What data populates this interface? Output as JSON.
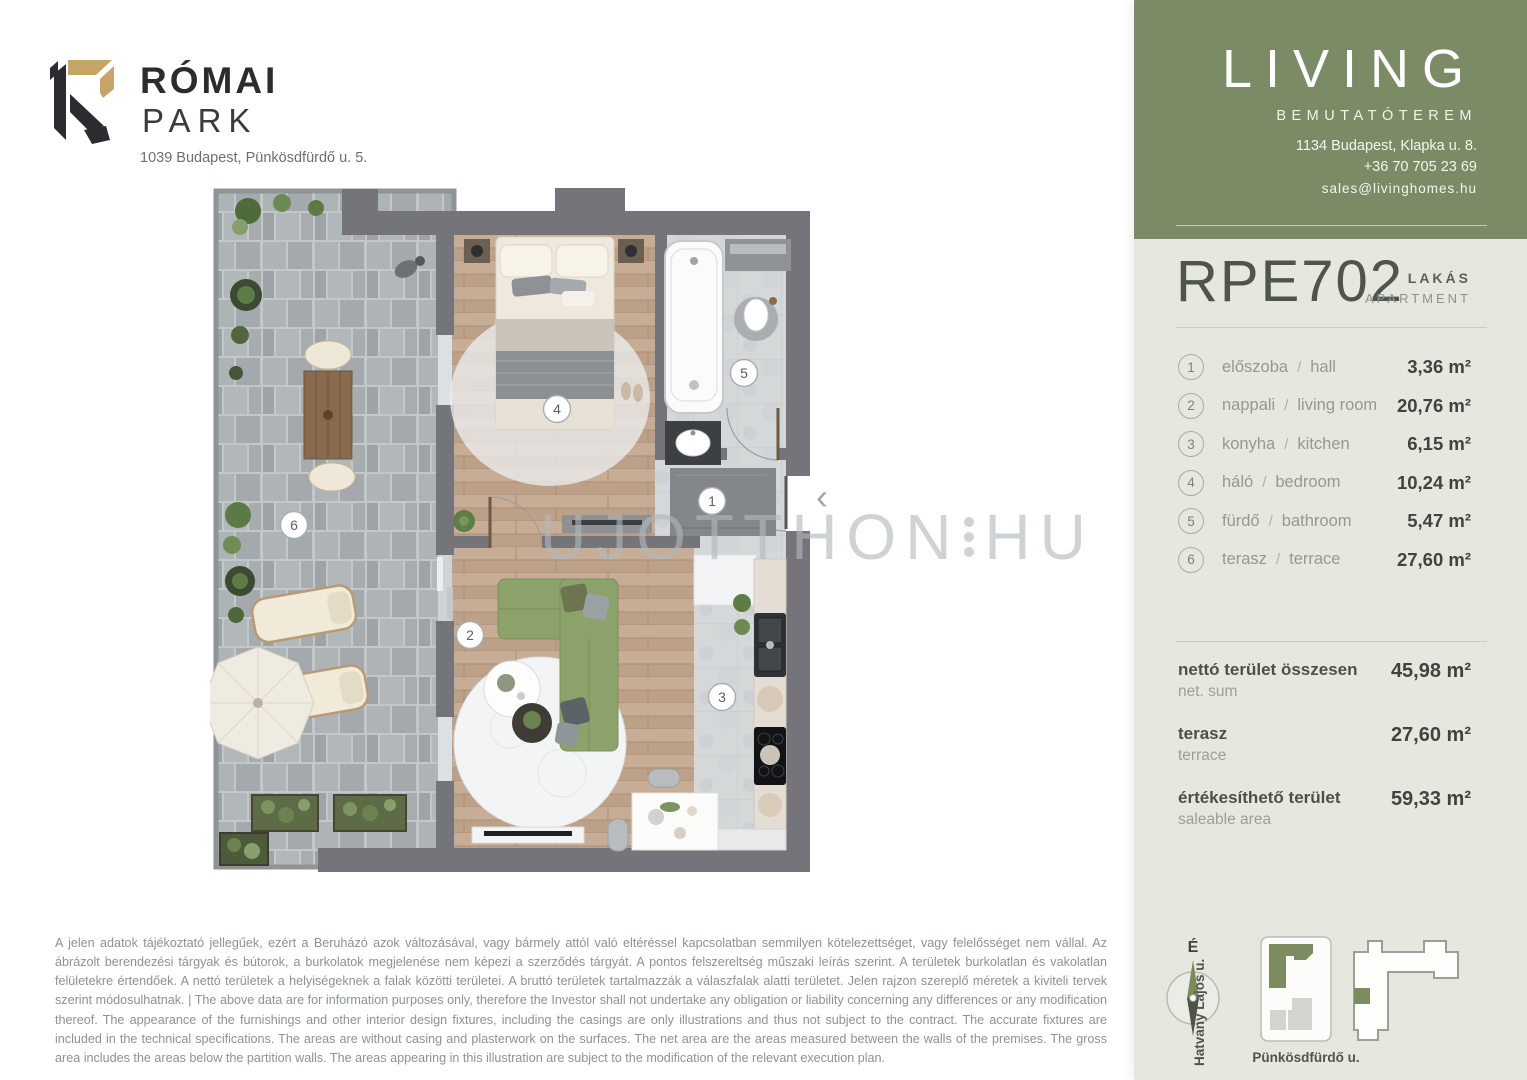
{
  "colors": {
    "sidebar_green": "#7a8b66",
    "panel_light": "#e6e8e0",
    "logo_gold": "#c7a467",
    "logo_black": "#2b2b30",
    "plan_wall_grey": "#74747a",
    "sofa_green": "#8ca26b"
  },
  "brand": {
    "name_line1": "RÓMAI",
    "name_line2": "PARK",
    "address": "1039 Budapest, Pünkösdfürdő u. 5."
  },
  "showroom": {
    "wordmark": "LIVING",
    "subtitle": "BEMUTATÓTEREM",
    "address": "1134 Budapest, Klapka u. 8.",
    "phone": "+36 70 705 23 69",
    "email": "sales@livinghomes.hu"
  },
  "unit": {
    "code": "RPE702",
    "type_hu": "LAKÁS",
    "type_en": "APARTMENT"
  },
  "ui": {
    "sep": "/",
    "entry_arrow": "‹"
  },
  "rooms": [
    {
      "num": "1",
      "hu": "előszoba",
      "en": "hall",
      "area": "3,36 m²"
    },
    {
      "num": "2",
      "hu": "nappali",
      "en": "living room",
      "area": "20,76 m²"
    },
    {
      "num": "3",
      "hu": "konyha",
      "en": "kitchen",
      "area": "6,15 m²"
    },
    {
      "num": "4",
      "hu": "háló",
      "en": "bedroom",
      "area": "10,24 m²"
    },
    {
      "num": "5",
      "hu": "fürdő",
      "en": "bathroom",
      "area": "5,47 m²"
    },
    {
      "num": "6",
      "hu": "terasz",
      "en": "terrace",
      "area": "27,60 m²"
    }
  ],
  "totals": [
    {
      "hu": "nettó terület összesen",
      "en": "net. sum",
      "area": "45,98 m²"
    },
    {
      "hu": "terasz",
      "en": "terrace",
      "area": "27,60 m²"
    },
    {
      "hu": "értékesíthető terület",
      "en": "saleable area",
      "area": "59,33 m²"
    }
  ],
  "disclaimer": "A jelen adatok tájékoztató jellegűek, ezért a Beruházó azok változásával, vagy bármely attól való eltéréssel kapcsolatban semmilyen kötelezettséget, vagy felelősséget nem vállal. Az ábrázolt berendezési tárgyak és bútorok, a burkolatok megjelenése nem képezi a szerződés tárgyát. A pontos felszereltség műszaki leírás szerint. A területek burkolatlan és vakolatlan felületekre értendőek. A nettó területek a helyiségeknek a falak közötti területei. A bruttó területek tartalmazzák a válaszfalak alatti területet. Jelen rajzon szereplő méretek a kiviteli tervek szerint módosulhatnak. | The above data are for information purposes only, therefore the Investor shall not undertake any obligation or liability concerning any differences or any modification thereof. The appearance of the furnishings and other interior design fixtures, including the casings are only illustrations and thus not subject to the contract. The accurate fixtures are included in the technical specifications. The areas are without casing and plasterwork on the surfaces. The net area are the areas measured between the walls of the premises. The gross area includes the areas below the partition walls. The areas appearing in this illustration are subject to the modification of the relevant execution plan.",
  "map": {
    "north": "É",
    "street_left": "Hatvany Lajos u.",
    "street_bottom": "Pünkösdfürdő u."
  },
  "watermark": {
    "left": "UJOTTHON",
    "right": "HU"
  }
}
